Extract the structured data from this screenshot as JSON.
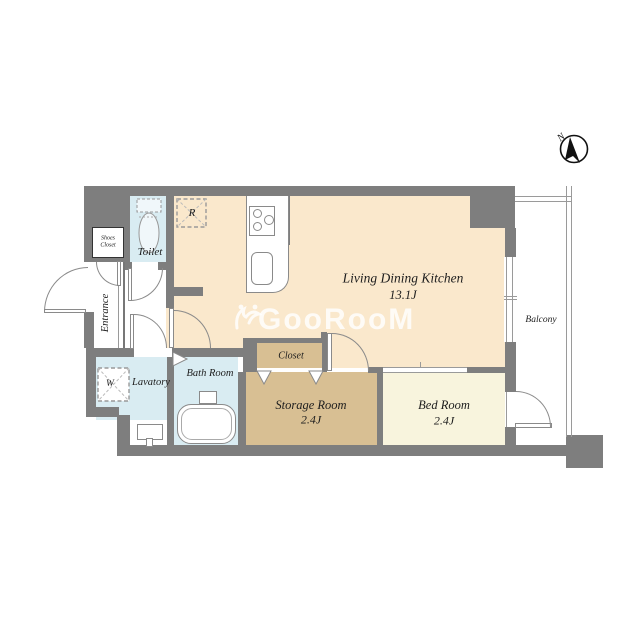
{
  "watermark": {
    "text": "GooRooM",
    "icon": "bird-logo"
  },
  "compass": {
    "label": "N"
  },
  "rooms": {
    "ldk": {
      "name": "Living Dining Kitchen",
      "size": "13.1J"
    },
    "bedroom": {
      "name": "Bed Room",
      "size": "2.4J"
    },
    "storage": {
      "name": "Storage Room",
      "size": "2.4J"
    },
    "closet": {
      "name": "Closet"
    },
    "bath": {
      "name": "Bath Room"
    },
    "lavatory": {
      "name": "Lavatory"
    },
    "toilet": {
      "name": "Toilet"
    },
    "entrance": {
      "name": "Entrance"
    },
    "shoes_closet": {
      "name": "Shoes Closet"
    },
    "balcony": {
      "name": "Balcony"
    }
  },
  "fixtures": {
    "refrigerator": "R",
    "washer": "W"
  },
  "colors": {
    "wall": "#7e7e7e",
    "ldk_fill": "#fae8cc",
    "storage_fill": "#d8bf93",
    "bedroom_fill": "#f8f4dd",
    "wet_area_fill": "#d9ecf2",
    "watermark": "rgba(255,255,255,0.82)"
  }
}
